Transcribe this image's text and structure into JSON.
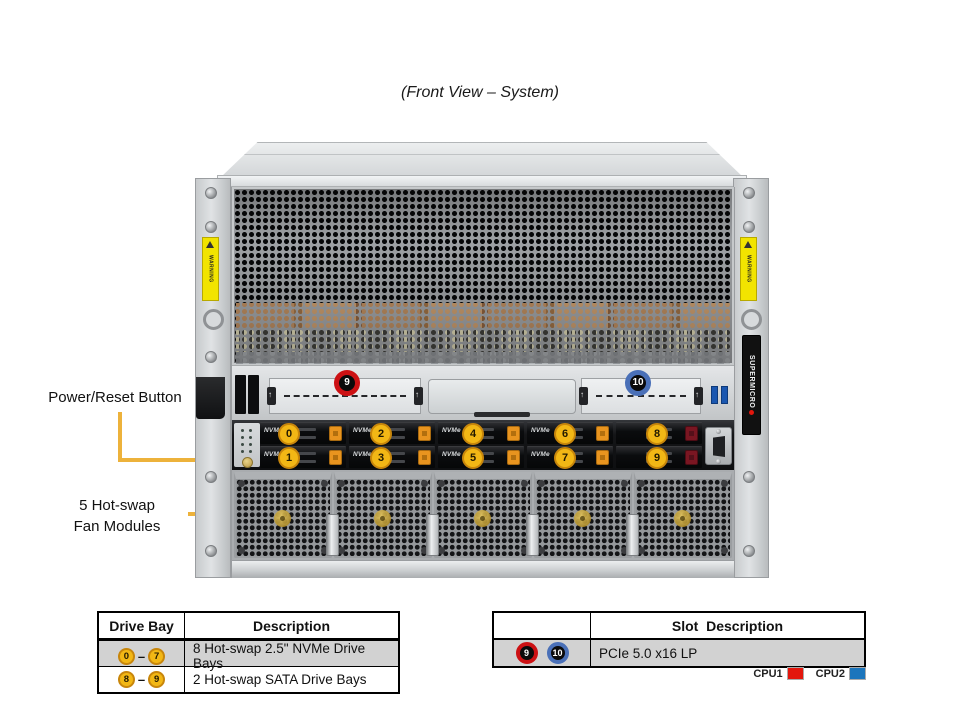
{
  "title": "(Front View – System)",
  "colors": {
    "callout_yellow": "#EDB23B",
    "badge_yellow_fill": "#F2B715",
    "badge_yellow_ring": "#C8860B",
    "slot9_red": "#CC1114",
    "slot10_blue": "#4A70B8",
    "cpu1_red": "#E3170D",
    "cpu2_blue": "#1B75BC",
    "table_row_gray": "#D2D2D2"
  },
  "callouts": {
    "power_reset": "Power/Reset Button",
    "fans_line1": "5 Hot-swap",
    "fans_line2": "Fan Modules"
  },
  "chassis": {
    "brand": "SUPERMICRO",
    "warning_label": "WARNING",
    "nvme_label": "NVMe",
    "fan_count": 5,
    "drive_bays": [
      {
        "num": "0",
        "type": "nvme"
      },
      {
        "num": "1",
        "type": "nvme"
      },
      {
        "num": "2",
        "type": "nvme"
      },
      {
        "num": "3",
        "type": "nvme"
      },
      {
        "num": "4",
        "type": "nvme"
      },
      {
        "num": "5",
        "type": "nvme"
      },
      {
        "num": "6",
        "type": "nvme"
      },
      {
        "num": "7",
        "type": "nvme"
      },
      {
        "num": "8",
        "type": "sata"
      },
      {
        "num": "9",
        "type": "sata"
      }
    ],
    "slot_badges": [
      {
        "num": "9",
        "color": "red"
      },
      {
        "num": "10",
        "color": "blue"
      }
    ]
  },
  "drive_table": {
    "headers": [
      "Drive Bay",
      "Description"
    ],
    "range_dash": "–",
    "rows": [
      {
        "from": "0",
        "to": "7",
        "description": "8 Hot-swap 2.5\" NVMe Drive Bays"
      },
      {
        "from": "8",
        "to": "9",
        "description": "2 Hot-swap SATA Drive Bays"
      }
    ]
  },
  "slot_table": {
    "header": "Slot  Description",
    "rows": [
      {
        "badges": [
          "9",
          "10"
        ],
        "description": "PCIe 5.0 x16 LP"
      }
    ]
  },
  "legend": [
    {
      "label": "CPU1",
      "color": "#E3170D"
    },
    {
      "label": "CPU2",
      "color": "#1B75BC"
    }
  ]
}
